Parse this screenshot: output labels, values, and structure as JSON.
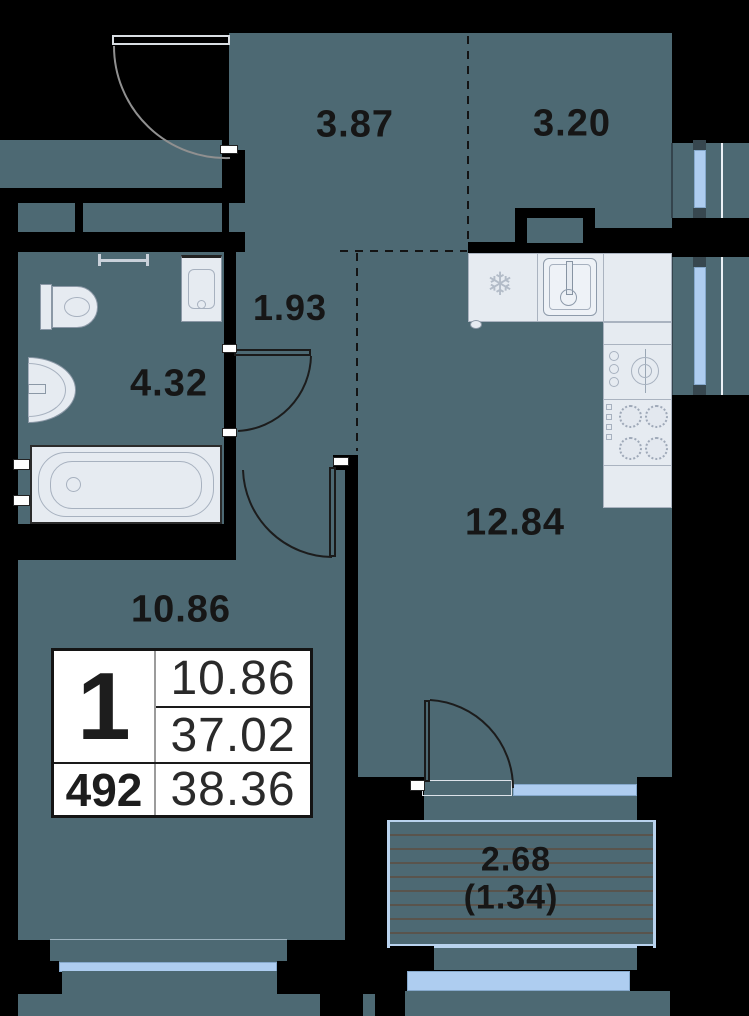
{
  "floor_plan": {
    "room_labels": [
      {
        "room": "entry-hall",
        "area": "3.87"
      },
      {
        "room": "kitchen-zone",
        "area": "3.20"
      },
      {
        "room": "inner-corridor",
        "area": "1.93"
      },
      {
        "room": "bathroom",
        "area": "4.32"
      },
      {
        "room": "kitchen-living",
        "area": "12.84"
      },
      {
        "room": "living-room",
        "area": "10.86"
      },
      {
        "room": "balcony",
        "area": "2.68",
        "area_coefficient": "(1.34)"
      }
    ],
    "info_card": {
      "rooms_count": "1",
      "unit_number": "492",
      "living_area": "10.86",
      "area_main": "37.02",
      "area_total": "38.36"
    },
    "colors": {
      "floor": "#4d6973",
      "walls": "#000000",
      "windows": "#aecdf0",
      "fixtures": "#e6ebf1",
      "card_background": "#ffffff",
      "text": "#161616",
      "balcony_hatch": "#59544d"
    },
    "icons": {
      "fridge_glyph": "❄"
    }
  }
}
